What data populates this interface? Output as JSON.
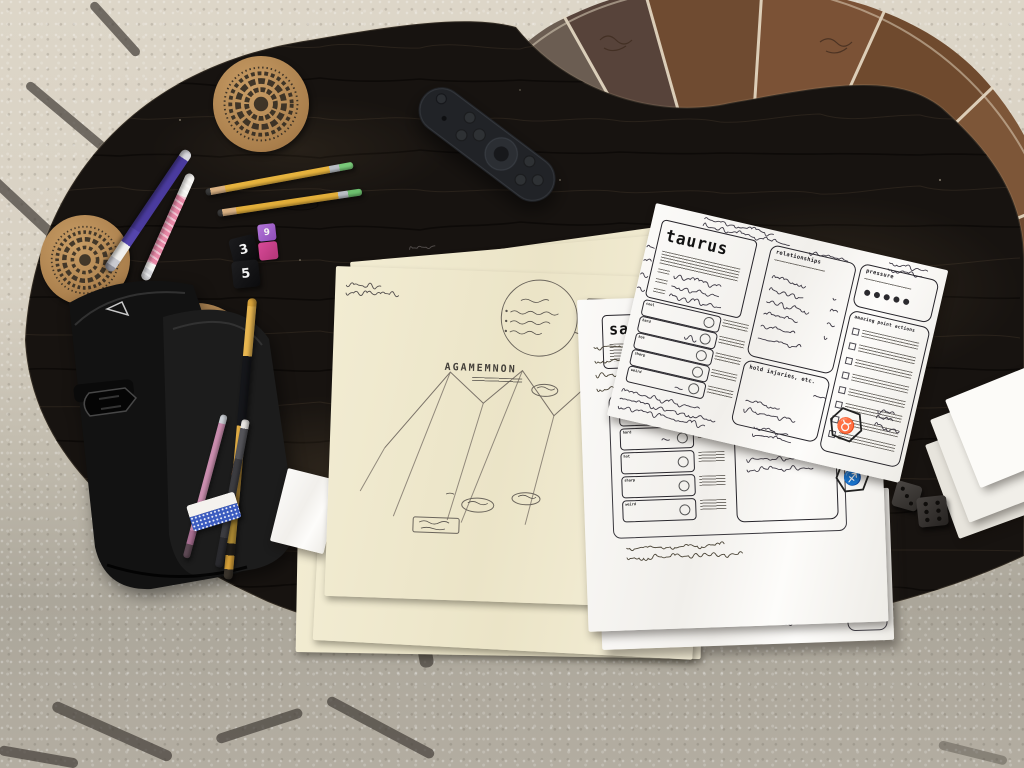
{
  "scene_colors": {
    "table_wood": "#171310",
    "carpet_light": "#ddd6c8",
    "carpet_shadow": "#aba69a",
    "pouf_leather": "#6e4a31",
    "pouf_piping": "#e8dcc6",
    "cork": "#b98a55",
    "paper_white": "#f7f5f1",
    "paper_cream": "#f0ead0",
    "pencil_yellow": "#e2ab3c",
    "eraser_green": "#6cbf6e",
    "pen_purple": "#4a3b9e",
    "pen_pink": "#e07a9a",
    "die_pink": "#d84a98",
    "ink": "#4a4550"
  },
  "taurus_sheet": {
    "title": "taurus",
    "zodiac_glyph": "♉",
    "sections": {
      "relationships": "relationships",
      "pressure": "pressure",
      "actions": "amazing point actions",
      "injuries": "hold injuries, etc."
    },
    "stats": [
      "cool",
      "hard",
      "hot",
      "sharp",
      "weird"
    ],
    "pressure_dots_filled": 5,
    "action_checkboxes": 8
  },
  "sagittarius_sheet": {
    "title_visible": "sa",
    "zodiac_glyph": "♐",
    "sections": {
      "injuries": "hold injuries, etc."
    },
    "stats": [
      "cool",
      "hard",
      "hot",
      "sharp",
      "weird"
    ]
  },
  "consequences_sheet": {
    "title": "mechanical consequences",
    "bullet_count": 8
  },
  "map_sheet": {
    "title": "AGAMEMNON"
  },
  "dice": {
    "black_values": [
      "3",
      "5"
    ],
    "pink_value": "9",
    "grey_pips": [
      3,
      6
    ]
  }
}
